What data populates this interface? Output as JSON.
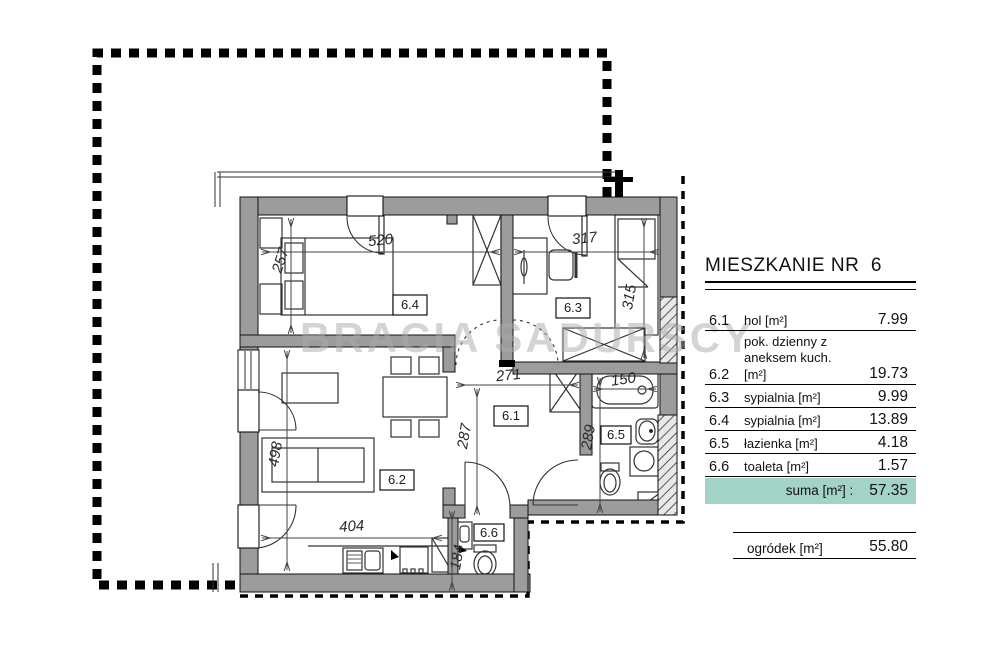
{
  "panel": {
    "title": "MIESZKANIE NR  6",
    "rows": [
      {
        "no": "6.1",
        "name": "hol [m²]",
        "area": "7.99"
      },
      {
        "no": "6.2",
        "name": "pok. dzienny z aneksem kuch. [m²]",
        "area": "19.73"
      },
      {
        "no": "6.3",
        "name": "sypialnia [m²]",
        "area": "9.99"
      },
      {
        "no": "6.4",
        "name": "sypialnia [m²]",
        "area": "13.89"
      },
      {
        "no": "6.5",
        "name": "łazienka [m²]",
        "area": "4.18"
      },
      {
        "no": "6.6",
        "name": "toaleta [m²]",
        "area": "1.57"
      }
    ],
    "suma_label": "suma [m²] :",
    "suma_value": "57.35",
    "suma_bg": "#a2d3c6",
    "ogrodek_label": "ogródek [m²]",
    "ogrodek_value": "55.80"
  },
  "plan": {
    "watermark": "BRACIA SADURSCY",
    "labels": {
      "r61": "6.1",
      "r62": "6.2",
      "r63": "6.3",
      "r64": "6.4",
      "r65": "6.5",
      "r66": "6.6"
    },
    "dims": {
      "d520": "520",
      "d317": "317",
      "d257": "257",
      "d315": "315",
      "d271": "271",
      "d287": "287",
      "d150": "150",
      "d289": "289",
      "d498": "498",
      "d404": "404",
      "d184": "184"
    }
  }
}
